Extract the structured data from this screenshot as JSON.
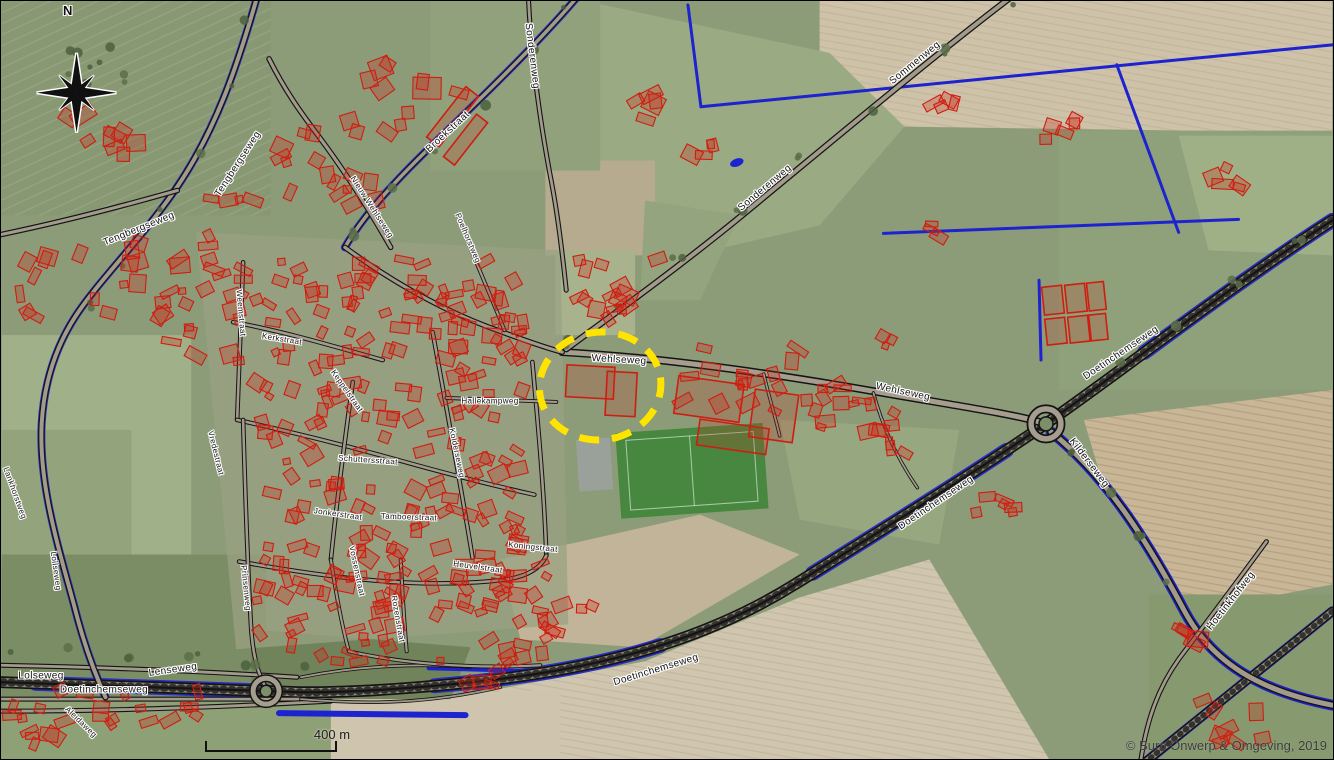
{
  "map": {
    "description": "Aerial photograph of a village with cadastral overlay (red buildings, black roads, blue watercourses) and a yellow dashed study-area ellipse",
    "north_label": "N",
    "scale_bar": {
      "label": "400 m"
    },
    "copyright": "© Buro Onwerp & Omgeving, 2019",
    "highlight": {
      "shape": "dashed-ellipse",
      "around": "village centre on Wehlseweg",
      "color": "#ffe400"
    },
    "legend_colors": {
      "building_outline": "#cf1d10",
      "watercourse": "#1d23cf",
      "road_casing": "#141414",
      "highlight_yellow": "#ffe400",
      "sports_pitch": "#48873f"
    },
    "street_labels": [
      {
        "text": "Tengbergseweg",
        "x": 237,
        "y": 163,
        "rot": -57,
        "size": 10
      },
      {
        "text": "Tengbergseweg",
        "x": 138,
        "y": 228,
        "rot": -22,
        "size": 10
      },
      {
        "text": "Broekstraat",
        "x": 447,
        "y": 131,
        "rot": -43,
        "size": 10
      },
      {
        "text": "Sonderenweg",
        "x": 531,
        "y": 55,
        "rot": 83,
        "size": 10
      },
      {
        "text": "Sommenweg",
        "x": 914,
        "y": 62,
        "rot": -39,
        "size": 10
      },
      {
        "text": "Sonderenweg",
        "x": 764,
        "y": 187,
        "rot": -40,
        "size": 10
      },
      {
        "text": "Wehlseweg",
        "x": 618,
        "y": 359,
        "rot": 3,
        "size": 10
      },
      {
        "text": "Wehlseweg",
        "x": 902,
        "y": 391,
        "rot": 12,
        "size": 10
      },
      {
        "text": "Hallekampweg",
        "x": 489,
        "y": 400,
        "rot": 0,
        "size": 8
      },
      {
        "text": "Nieuw Wehlseweg",
        "x": 371,
        "y": 206,
        "rot": 57,
        "size": 8
      },
      {
        "text": "Poelhorstweg",
        "x": 467,
        "y": 237,
        "rot": 67,
        "size": 8
      },
      {
        "text": "Weemstraat",
        "x": 240,
        "y": 312,
        "rot": 85,
        "size": 8
      },
      {
        "text": "Kerkstraat",
        "x": 281,
        "y": 338,
        "rot": 9,
        "size": 8
      },
      {
        "text": "Keppelstraat",
        "x": 346,
        "y": 390,
        "rot": 55,
        "size": 8
      },
      {
        "text": "Schuttersstraat",
        "x": 367,
        "y": 459,
        "rot": 4,
        "size": 8
      },
      {
        "text": "Kolderseweg",
        "x": 456,
        "y": 452,
        "rot": 78,
        "size": 8
      },
      {
        "text": "Jonkerstraat",
        "x": 337,
        "y": 513,
        "rot": 8,
        "size": 8
      },
      {
        "text": "Tamboerstraat",
        "x": 408,
        "y": 516,
        "rot": 2,
        "size": 8
      },
      {
        "text": "Koningstraat",
        "x": 532,
        "y": 546,
        "rot": 6,
        "size": 8
      },
      {
        "text": "Heuvelstraat",
        "x": 477,
        "y": 566,
        "rot": 8,
        "size": 8
      },
      {
        "text": "Vossenstraat",
        "x": 356,
        "y": 570,
        "rot": 78,
        "size": 8
      },
      {
        "text": "Rozenstraat",
        "x": 397,
        "y": 618,
        "rot": 80,
        "size": 8
      },
      {
        "text": "Prinsenweg",
        "x": 245,
        "y": 587,
        "rot": 84,
        "size": 8
      },
      {
        "text": "Vredestraat",
        "x": 215,
        "y": 452,
        "rot": 76,
        "size": 8
      },
      {
        "text": "Lankhorstweg",
        "x": 14,
        "y": 492,
        "rot": 70,
        "size": 8
      },
      {
        "text": "Loilseweg",
        "x": 55,
        "y": 570,
        "rot": 82,
        "size": 8
      },
      {
        "text": "Lolseweg",
        "x": 40,
        "y": 675,
        "rot": 0,
        "size": 10
      },
      {
        "text": "Doetinchemseweg",
        "x": 103,
        "y": 689,
        "rot": 0,
        "size": 10
      },
      {
        "text": "Lenseweg",
        "x": 172,
        "y": 669,
        "rot": -8,
        "size": 10
      },
      {
        "text": "Aleidaweg",
        "x": 80,
        "y": 721,
        "rot": 44,
        "size": 8
      },
      {
        "text": "Doetinchemseweg",
        "x": 655,
        "y": 669,
        "rot": -17,
        "size": 10
      },
      {
        "text": "Doetinchemseweg",
        "x": 935,
        "y": 502,
        "rot": -34,
        "size": 10
      },
      {
        "text": "Doetinchemseweg",
        "x": 1120,
        "y": 352,
        "rot": -34,
        "size": 10
      },
      {
        "text": "Kilderseweg",
        "x": 1088,
        "y": 462,
        "rot": 53,
        "size": 10
      },
      {
        "text": "Hoetinkhofweg",
        "x": 1230,
        "y": 600,
        "rot": -52,
        "size": 10
      }
    ]
  }
}
